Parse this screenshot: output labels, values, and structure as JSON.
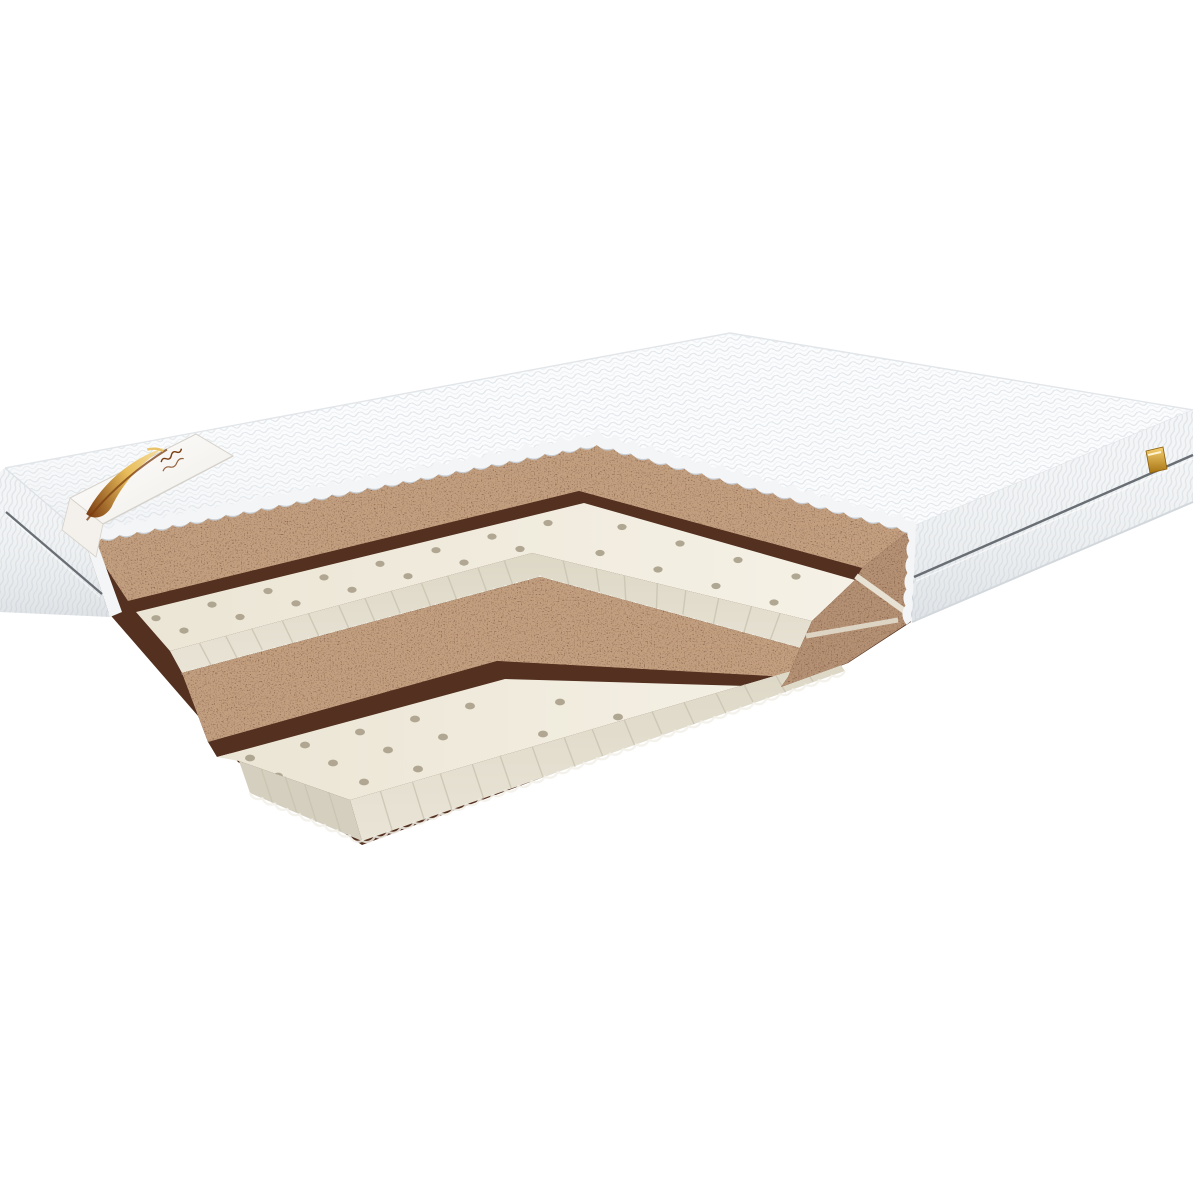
{
  "meta": {
    "type": "product-image",
    "subject": "Mattress cutaway render showing internal coconut coir and perforated latex layers",
    "background": "#ffffff"
  },
  "colors": {
    "bg": "#ffffff",
    "cover_base": "#fbfcfd",
    "cover_line": "#e1e5e9",
    "cover_line_soft": "#edf0f3",
    "cover_edge": "#f3f5f7",
    "cover_edge_line": "#c6ccd2",
    "side_base": "#f3f5f6",
    "side_rib": "#dfe3e7",
    "side_shadow": "#d2d7dc",
    "silhouette": "#e2e6e9",
    "seam": "#686e74",
    "coir_dark": "#5f3523",
    "coir_mid": "#7d4c34",
    "coir_light": "#96613f",
    "coir_face": "#53301f",
    "latex_top": "#f0ebdd",
    "latex_light": "#f5f1e6",
    "latex_face": "#ddd7c6",
    "latex_rib": "#c8c2b0",
    "latex_frill": "#f2f0e7",
    "latex_hole": "#a89f8a",
    "fringe_shadow": "#ccd3d9",
    "label_base": "#ffffff",
    "label_shade": "#efece6",
    "label_edge": "#d6d2cb",
    "logo_brown": "#7a3c12",
    "logo_gold": "#e8bc5a",
    "logo_cream": "#f6e2a8",
    "tag_gold": "#e4b44a",
    "tag_gold_dark": "#a87414"
  },
  "components": {
    "top_cover": "quilted-cover-top",
    "side_panel_right": "quilted-side-panel-right",
    "side_panel_left": "quilted-side-panel-left",
    "brand_label": "corner-ribbon-label",
    "brand_logo": "gold-swoosh-logo",
    "side_tag": "gold-side-tag",
    "seam_right": "side-piping-seam",
    "seam_left": "side-piping-seam",
    "layer_coir_upper": "coconut-coir-layer",
    "layer_latex_upper": "perforated-latex-layer",
    "layer_coir_lower": "coconut-coir-layer",
    "layer_latex_lower": "perforated-latex-layer",
    "bottom_fabric": "wavy-bottom-cover-fringe"
  }
}
